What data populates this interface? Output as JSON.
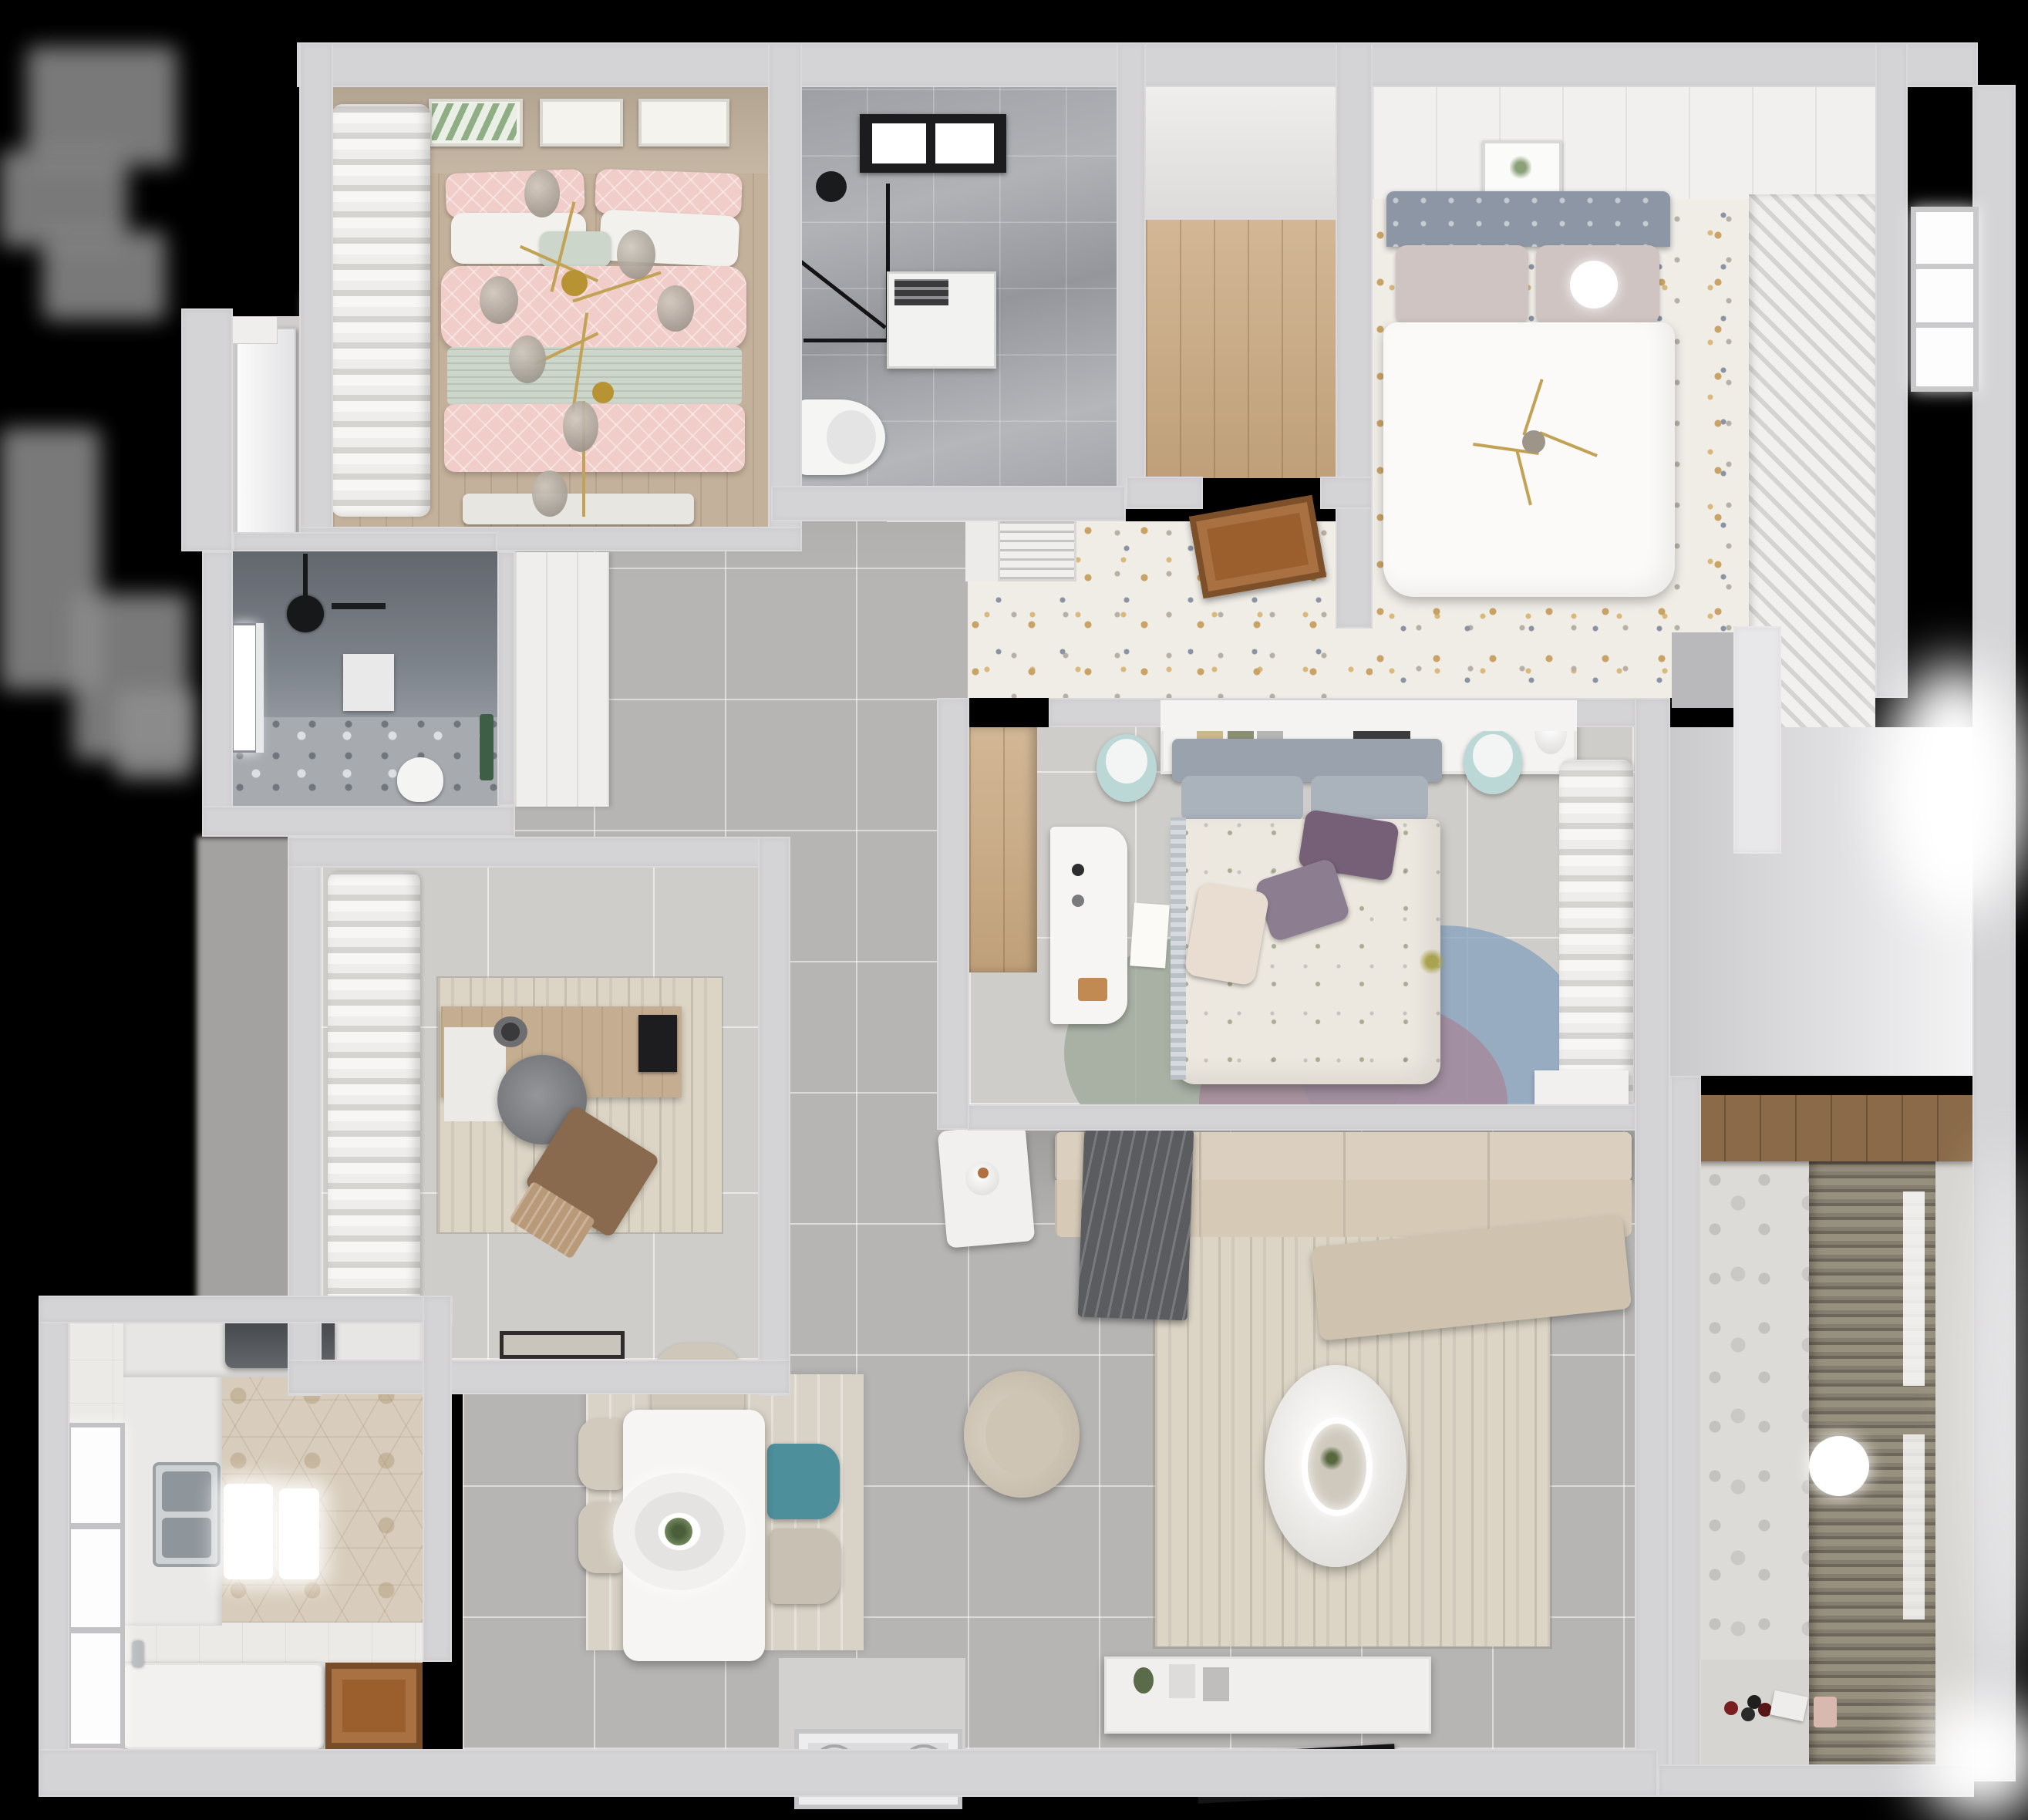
{
  "scene": {
    "type": "3d-floor-plan-top-down-render",
    "description": "Photorealistic overhead render of a furnished apartment floor plan on a black background"
  },
  "palette": {
    "canvas": "#000000",
    "wall": "#d4d3d5",
    "hallTile": "#b6b5b3",
    "terrazzoBase": "#f0ede7",
    "marble": "#a6a8ad",
    "woodLight": "#c9a87f",
    "woodFloor": "#c4b19b",
    "woodDoor": "#9a5f2d",
    "pinkBed": "#f0cdc9",
    "sageBlanket": "#ccd6cb",
    "tealChair": "#4e8f9c",
    "sofaBeige": "#d6cab7",
    "throwGrey": "#5a5c60",
    "rugBeige": "#dcd5c6",
    "hexTile": "#d8cdbc",
    "hoodGrey": "#54575b",
    "showerDark": "#787e86",
    "headboardBlue": "#8c96a4",
    "curtainWhite": "#f3f2f0",
    "blindTaupe": "#8a8172",
    "pillowPurple": "#756077",
    "rugGreen": "#a2ab9f",
    "rugBlue": "#89a4bf",
    "rugMauve": "#a5899a",
    "gold": "#c2a254"
  },
  "rooms": {
    "bedroom1": {
      "label": "Bedroom with pink bedding and brass chandelier"
    },
    "vestibule": {
      "label": "Vestibule with white door"
    },
    "shower": {
      "label": "Dark tiled shower room with toilet"
    },
    "study": {
      "label": "Study with desk, monitor and lounge chair"
    },
    "kitchen": {
      "label": "Kitchen with hex tile, double sink, hood and island"
    },
    "hall": {
      "label": "Main hall with grey floor tiles"
    },
    "dining": {
      "label": "Dining area with white table and pendant lamp"
    },
    "bathroom1": {
      "label": "Bathroom with skylight, shower enclosure, washer and toilet"
    },
    "closet": {
      "label": "Walk-in closet with wood floor"
    },
    "bedroom2": {
      "label": "Bedroom with white bed, terrazzo floor and slatted wardrobe"
    },
    "corridor": {
      "label": "Corridor with speckled terrazzo floor and open wood door"
    },
    "master": {
      "label": "Master bedroom with floral bed, desk and round rug"
    },
    "living": {
      "label": "Living room with sectional sofa, round coffee table and TV"
    },
    "entry": {
      "label": "Entry alcove with bright daylight glow"
    },
    "balcony": {
      "label": "Balcony with patterned tile, roller blinds and ceiling lamp"
    }
  },
  "furniture_inventory": {
    "bedroom1": [
      "picture-frames",
      "pink-double-bed",
      "pillows",
      "sage-blanket",
      "brass-chandelier",
      "left-curtain",
      "window",
      "bench"
    ],
    "shower": [
      "window",
      "black-shower-head",
      "wall-niche",
      "toilet",
      "plant"
    ],
    "study": [
      "white-ruffle-curtain",
      "wood-desk",
      "monitor",
      "desk-mat",
      "grey-swivel-chair",
      "brown-lounge-chair",
      "area-rug",
      "doormat"
    ],
    "kitchen": [
      "window",
      "counter-L",
      "range-hood",
      "double-sink",
      "island-counter",
      "open-wood-door",
      "pendant-glow-lights"
    ],
    "dining": [
      "wood-area-rug",
      "white-table",
      "round-pendant-lamp",
      "four-chairs",
      "entry-door-with-gold-handles"
    ],
    "bathroom1": [
      "black-frame-skylight",
      "shower-glass",
      "washing-machine",
      "toilet"
    ],
    "bedroom2": [
      "panel-ceiling",
      "picture-frame",
      "grey-headboard-bed",
      "white-duvet",
      "ball-lamp",
      "slatted-wardrobe",
      "window"
    ],
    "corridor": [
      "ac-vent",
      "open-wood-door"
    ],
    "master": [
      "headboard-shelf-with-books",
      "two-teal-stools",
      "floral-duvet-bed",
      "purple-pillows",
      "white-desk",
      "paper-sheet",
      "tri-circle-rug",
      "sheer-curtain",
      "low-cabinet",
      "wood-niche"
    ],
    "living": [
      "back-console",
      "sectional-sofa",
      "grey-throw",
      "chaise",
      "beige-rug",
      "round-coffee-table",
      "armchair",
      "side-table-with-vase",
      "tv-console",
      "flat-tv"
    ],
    "balcony": [
      "pattern-tile-wall",
      "roller-blinds",
      "ceiling-lamp",
      "toys",
      "wood-shelf"
    ]
  }
}
